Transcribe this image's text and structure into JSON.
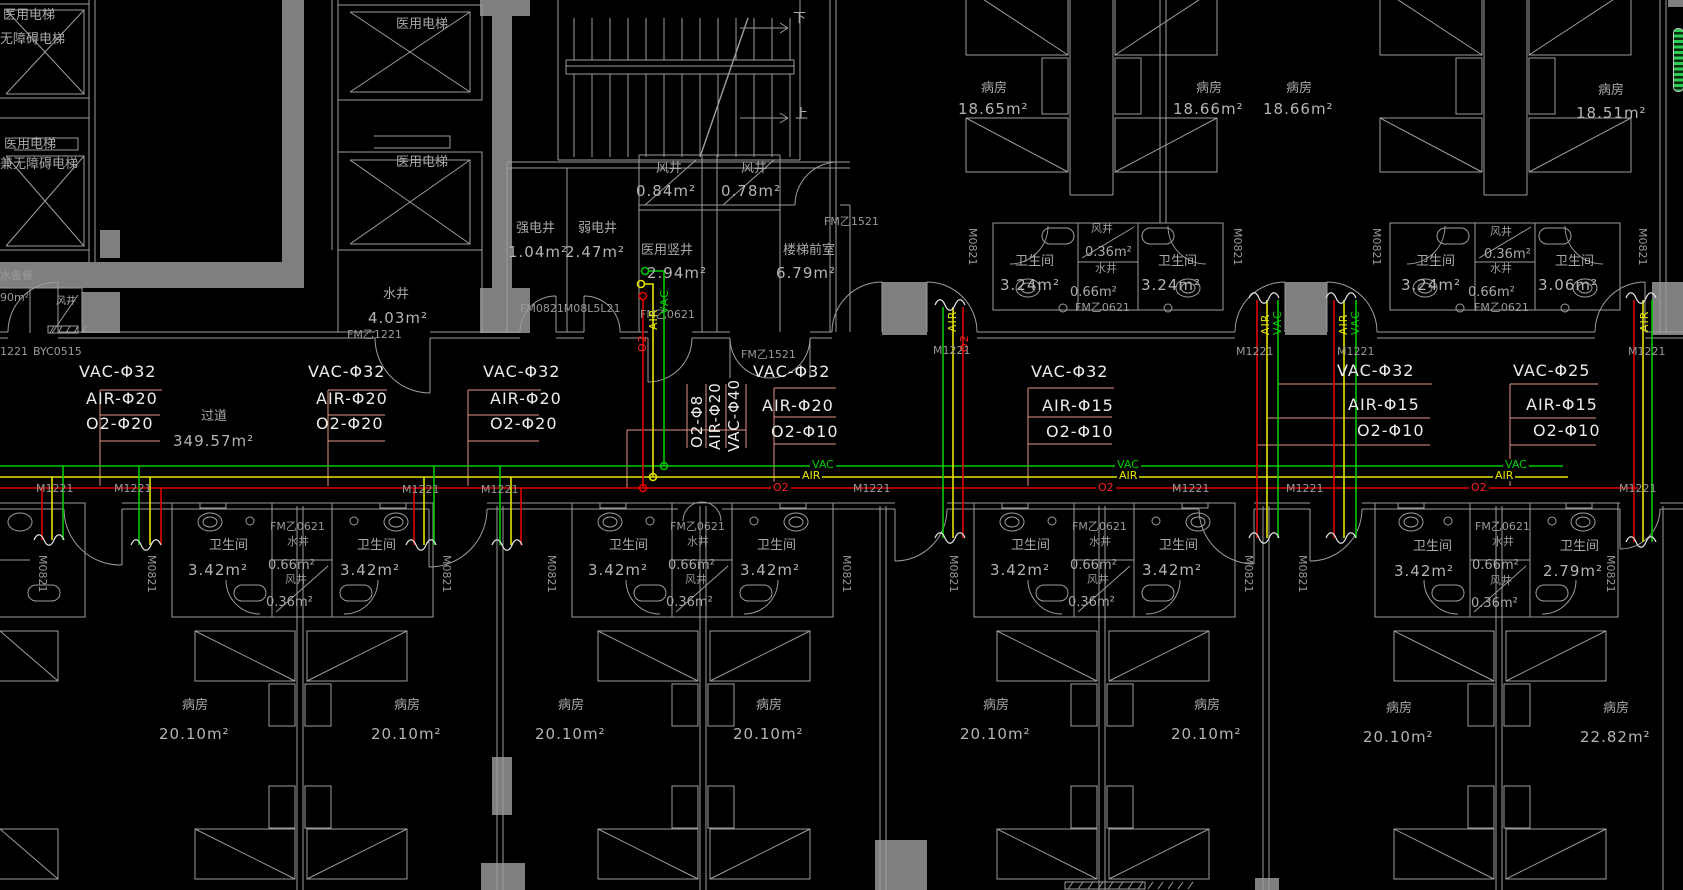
{
  "colors": {
    "background": "#000000",
    "wall_line": "#9d9d9d",
    "wall_fill": "#7f7f7f",
    "vac": "#00c800",
    "air": "#e4e400",
    "o2": "#e00000",
    "leader": "#e49382",
    "text": "#a9a9a9",
    "pipe_label_text": "#ececec",
    "scroll_indicator": "#2ecc55"
  },
  "pipes": {
    "vac": "VAC",
    "air": "AIR",
    "o2": "O2"
  },
  "pipe_groups": [
    {
      "vac": "VAC-Φ32",
      "air": "AIR-Φ20",
      "o2": "O2-Φ20"
    },
    {
      "vac": "VAC-Φ32",
      "air": "AIR-Φ20",
      "o2": "O2-Φ20"
    },
    {
      "vac": "VAC-Φ32",
      "air": "AIR-Φ20",
      "o2": "O2-Φ20"
    },
    {
      "vac": "VAC-Φ40",
      "air": "AIR-Φ20",
      "o2": "O2-Φ8"
    },
    {
      "vac": "VAC-Φ32",
      "air": "AIR-Φ20",
      "o2": "O2-Φ10"
    },
    {
      "vac": "VAC-Φ32",
      "air": "AIR-Φ15",
      "o2": "O2-Φ10"
    },
    {
      "vac": "VAC-Φ32",
      "air": "AIR-Φ15",
      "o2": "O2-Φ10"
    },
    {
      "vac": "VAC-Φ25",
      "air": "AIR-Φ15",
      "o2": "O2-Φ10"
    }
  ],
  "elevators": {
    "label": "医用电梯",
    "sub1": "无障碍电梯",
    "sub2": "兼无障碍电梯"
  },
  "shafts": {
    "water": "水井",
    "water_area_top": "4.03m²",
    "strong": "强电井",
    "strong_area": "1.04m²",
    "weak": "弱电井",
    "weak_area": "2.47m²",
    "medical": "医用竖井",
    "medical_area": "2.94m²",
    "vent": "风井",
    "vent1_area": "0.84m²",
    "vent2_area": "0.78m²",
    "vent_small_area": "0.36m²",
    "water_small_area": "0.66m²"
  },
  "stairs": {
    "up": "上",
    "down": "下",
    "lobby": "楼梯前室",
    "lobby_area": "6.79m²"
  },
  "corridor": {
    "name": "过道",
    "area": "349.57m²"
  },
  "pantry": {
    "name": "水备餐",
    "area": "90m²"
  },
  "doors": {
    "fm1221": "FM乙1221",
    "fm1521": "FM乙1521",
    "fm0621": "FM乙0621",
    "m1221": "M1221",
    "m1221_cut": "1221",
    "m0821": "M0821",
    "byc": "BYC0515",
    "overlap": "FM0821M08L5L21"
  },
  "bath": {
    "name": "卫生间"
  },
  "bathrooms_top": [
    {
      "left_area": "3.24m²",
      "right_area": "3.24m²"
    },
    {
      "left_area": "3.24m²",
      "right_area": "3.06m²"
    }
  ],
  "bathrooms_bottom": [
    {
      "left_area": "3.42m²",
      "right_area": "3.42m²"
    },
    {
      "left_area": "3.42m²",
      "right_area": "3.42m²"
    },
    {
      "left_area": "3.42m²",
      "right_area": "3.42m²"
    },
    {
      "left_area": "3.42m²",
      "right_area": "2.79m²"
    }
  ],
  "wards_top": [
    {
      "name": "病房",
      "area": "18.65m²"
    },
    {
      "name": "病房",
      "area": "18.66m²"
    },
    {
      "name": "病房",
      "area": "18.66m²"
    },
    {
      "name": "病房",
      "area": "18.51m²"
    }
  ],
  "wards_bottom": [
    {
      "name": "病房",
      "area": "20.10m²"
    },
    {
      "name": "病房",
      "area": "20.10m²"
    },
    {
      "name": "病房",
      "area": "20.10m²"
    },
    {
      "name": "病房",
      "area": "20.10m²"
    },
    {
      "name": "病房",
      "area": "20.10m²"
    },
    {
      "name": "病房",
      "area": "20.10m²"
    },
    {
      "name": "病房",
      "area": "20.10m²"
    },
    {
      "name": "病房",
      "area": "22.82m²"
    }
  ]
}
